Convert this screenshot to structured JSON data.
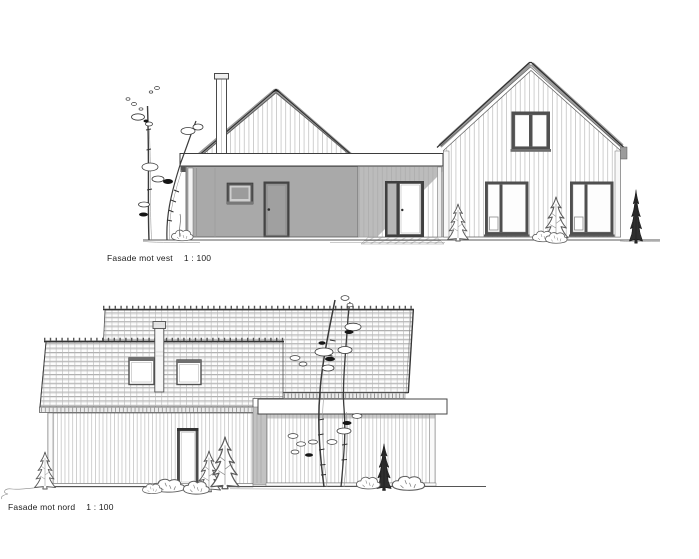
{
  "captions": {
    "vest": {
      "title": "Fasade mot vest",
      "scale": "1 : 100"
    },
    "nord": {
      "title": "Fasade mot nord",
      "scale": "1 : 100"
    }
  },
  "drawing": {
    "type": "architectural elevation sheet",
    "facades": [
      {
        "id": "vest",
        "label": "Fasade mot vest",
        "scale": "1 : 100"
      },
      {
        "id": "nord",
        "label": "Fasade mot nord",
        "scale": "1 : 100"
      }
    ]
  },
  "colors": {
    "paper": "#ffffff",
    "line": "#3a3a3a",
    "garage_wall_gray": "#a9a9a9",
    "window_frame_dark": "#4f4f4f",
    "shadow_gray": "#9c9c9c",
    "tile_line_gray": "#8f8f8f",
    "siding_line_gray": "#c4c4c4"
  }
}
